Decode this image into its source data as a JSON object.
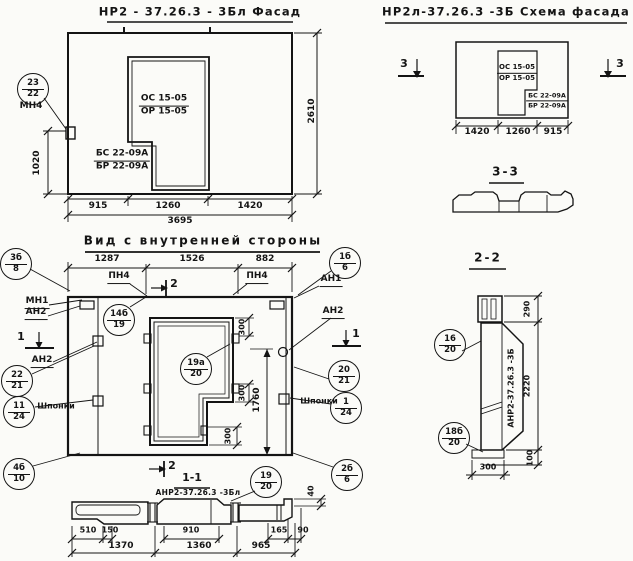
{
  "colors": {
    "ink": "#141414",
    "paper": "#fbfbf8"
  },
  "facade": {
    "title": "НР2 - 37.26.3  - 3Бл  Фасад",
    "window_mark": {
      "top": "ОС 15-05",
      "bottom": "ОР 15-05"
    },
    "block_mark": {
      "top": "БС 22-09А",
      "bottom": "БР 22-09А"
    },
    "callout_23_22": {
      "top": "23",
      "bottom": "22"
    },
    "anchor_label": "МН4",
    "dim_left": "1020",
    "dim_right": "2610",
    "dims_bottom": [
      "915",
      "1260",
      "1420"
    ],
    "dim_total": "3695"
  },
  "schema": {
    "title": "НР2л-37.26.3  -3Б  Схема фасада",
    "window_mark": {
      "top": "ОС 15-05",
      "bottom": "ОР 15-05"
    },
    "block_mark": {
      "top": "БС 22-09А",
      "bottom": "БР 22-09А"
    },
    "section_mark": "3",
    "dims_bottom": [
      "1420",
      "1260",
      "915"
    ]
  },
  "section33": {
    "title": "3-3"
  },
  "section22": {
    "title": "2-2",
    "panel_mark": "АНР2-37.26.3 -3Б",
    "callout_16_20": {
      "top": "16",
      "bottom": "20"
    },
    "callout_18b_20": {
      "top": "18б",
      "bottom": "20"
    },
    "dim_290": "290",
    "dim_2220": "2220",
    "dim_100": "100",
    "dim_300": "300"
  },
  "inner": {
    "title": "Вид с внутренней стороны",
    "dims_top": [
      "1287",
      "1526",
      "882"
    ],
    "pn4": "ПН4",
    "section1": "1",
    "section2": "2",
    "mn1": "МН1",
    "an1": "АН1",
    "an2": "АН2",
    "shponki": "Шпонки",
    "callout_3b_8": {
      "top": "3б",
      "bottom": "8"
    },
    "callout_22_21": {
      "top": "22",
      "bottom": "21"
    },
    "callout_11_24": {
      "top": "11",
      "bottom": "24"
    },
    "callout_4b_10": {
      "top": "4б",
      "bottom": "10"
    },
    "callout_14b_19": {
      "top": "14б",
      "bottom": "19"
    },
    "callout_19a_20": {
      "top": "19а",
      "bottom": "20"
    },
    "callout_1b_6": {
      "top": "1б",
      "bottom": "6"
    },
    "callout_20_21": {
      "top": "20",
      "bottom": "21"
    },
    "callout_1_24": {
      "top": "1",
      "bottom": "24"
    },
    "callout_2b_6": {
      "top": "2б",
      "bottom": "6"
    },
    "dim_300": "300",
    "dim_1760": "1760"
  },
  "section11": {
    "title": "1-1",
    "panel_mark": "АНР2-37.26.3 -3Бл",
    "callout_19_20": {
      "top": "19",
      "bottom": "20"
    },
    "dim_40": "40",
    "dims_row1": [
      "510",
      "150",
      "910",
      "165",
      "90"
    ],
    "dims_row2": [
      "1370",
      "1360",
      "965"
    ]
  }
}
